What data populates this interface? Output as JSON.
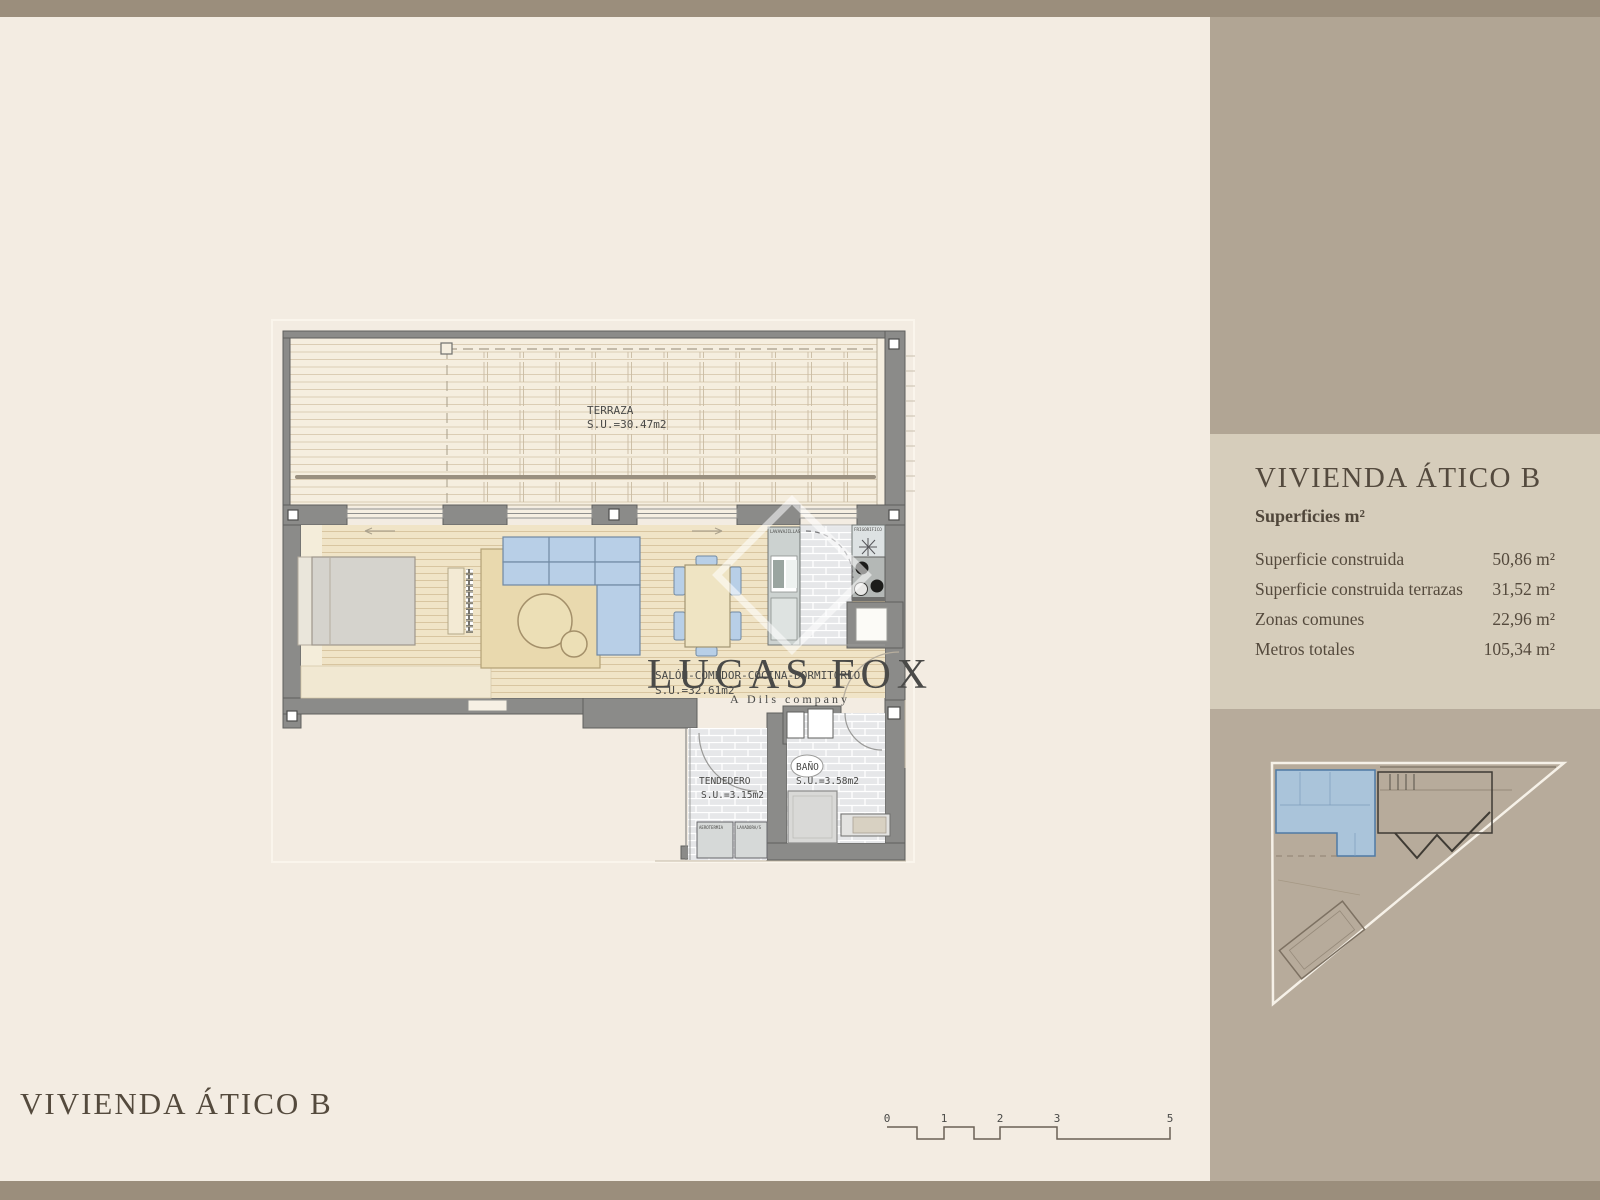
{
  "titles": {
    "main_bottom": "VIVIENDA ÁTICO B"
  },
  "sidebar": {
    "title": "VIVIENDA ÁTICO B",
    "subtitle": "Superficies m²",
    "rows": [
      {
        "label": "Superficie construida",
        "value": "50,86 m²"
      },
      {
        "label": "Superficie construida terrazas",
        "value": "31,52 m²"
      },
      {
        "label": "Zonas comunes",
        "value": "22,96 m²"
      },
      {
        "label": "Metros totales",
        "value": "105,34 m²"
      }
    ]
  },
  "plan": {
    "terraza": {
      "name": "TERRAZA",
      "area": "S.U.=30.47m2"
    },
    "salon": {
      "name": "SALÓN-COMEDOR-COCINA-DORMITORIO",
      "area": "S.U.=32.61m2"
    },
    "tendedero": {
      "name": "TENDEDERO",
      "area": "S.U.=3.15m2"
    },
    "bano": {
      "name": "BAÑO",
      "area": "S.U.=3.58m2"
    },
    "kitchen": {
      "lavavajillas": "LAVAVAJILLAS",
      "frigorifico": "FRIGORIFICO"
    },
    "utility": {
      "aerotermia": "AEROTERMIA",
      "lavadora": "LAVADORA/S"
    }
  },
  "watermark": {
    "line1": "LUCAS FOX",
    "line2": "A Dils company"
  },
  "scalebar": {
    "labels": [
      "0",
      "1",
      "2",
      "3",
      "5"
    ]
  },
  "colors": {
    "cream": "#f3ece2",
    "taupe_strip": "#9b8e7c",
    "taupe_mid": "#b1a594",
    "panel": "#d6cdbb",
    "taupe_low": "#b7ab9b",
    "wall_gray": "#8b8b89",
    "accent_blue": "#b8cfe7",
    "wood": "#f0e4c7",
    "text_brown": "#554a3d"
  }
}
